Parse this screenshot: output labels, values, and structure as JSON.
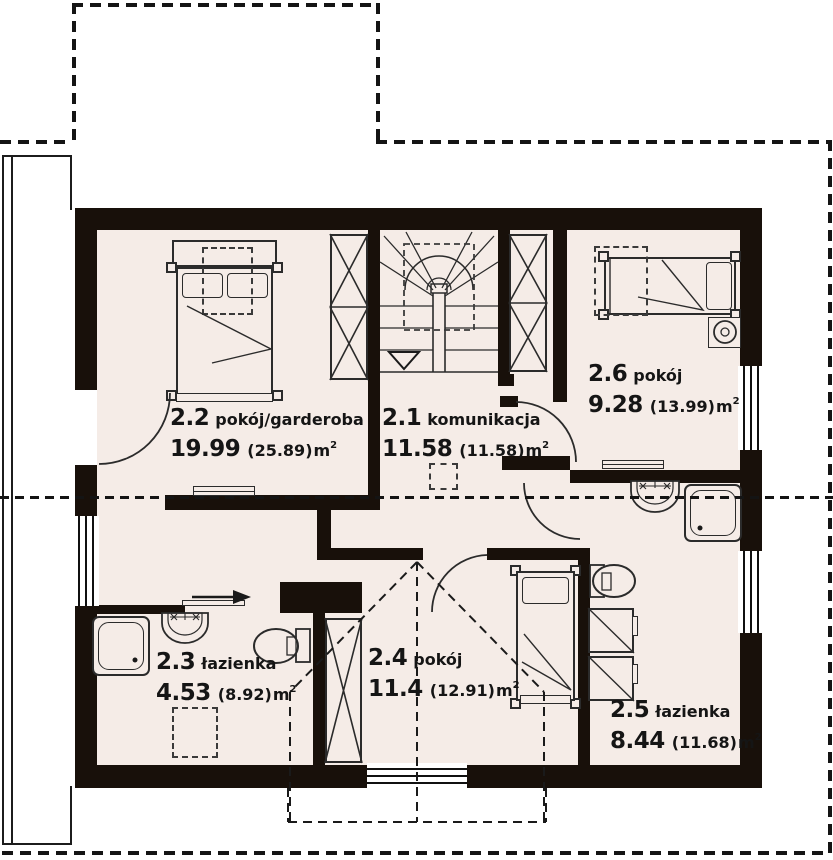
{
  "plan_type": "floor-plan",
  "colors": {
    "wall": "#18100a",
    "floor": "#f5ece7",
    "line": "#2b2b2b",
    "background": "#ffffff"
  },
  "rooms": [
    {
      "number": "2.1",
      "name": "komunikacja",
      "area_net": "11.58",
      "area_gross": "(11.58)",
      "unit": "m",
      "unit_exp": "2"
    },
    {
      "number": "2.2",
      "name": "pokój/garderoba",
      "area_net": "19.99",
      "area_gross": "(25.89)",
      "unit": "m",
      "unit_exp": "2"
    },
    {
      "number": "2.3",
      "name": "łazienka",
      "area_net": "4.53",
      "area_gross": "(8.92)",
      "unit": "m",
      "unit_exp": "2"
    },
    {
      "number": "2.4",
      "name": "pokój",
      "area_net": "11.4",
      "area_gross": "(12.91)",
      "unit": "m",
      "unit_exp": "2"
    },
    {
      "number": "2.5",
      "name": "łazienka",
      "area_net": "8.44",
      "area_gross": "(11.68)",
      "unit": "m",
      "unit_exp": "2"
    },
    {
      "number": "2.6",
      "name": "pokój",
      "area_net": "9.28",
      "area_gross": "(13.99)",
      "unit": "m",
      "unit_exp": "2"
    }
  ],
  "fixtures": [
    "double-bed",
    "single-bed",
    "wardrobe",
    "winder-staircase",
    "shower",
    "washbasin",
    "toilet",
    "washing-machine",
    "sliding-door",
    "chimney",
    "radiator",
    "roof-outline",
    "section-line",
    "skylight"
  ]
}
